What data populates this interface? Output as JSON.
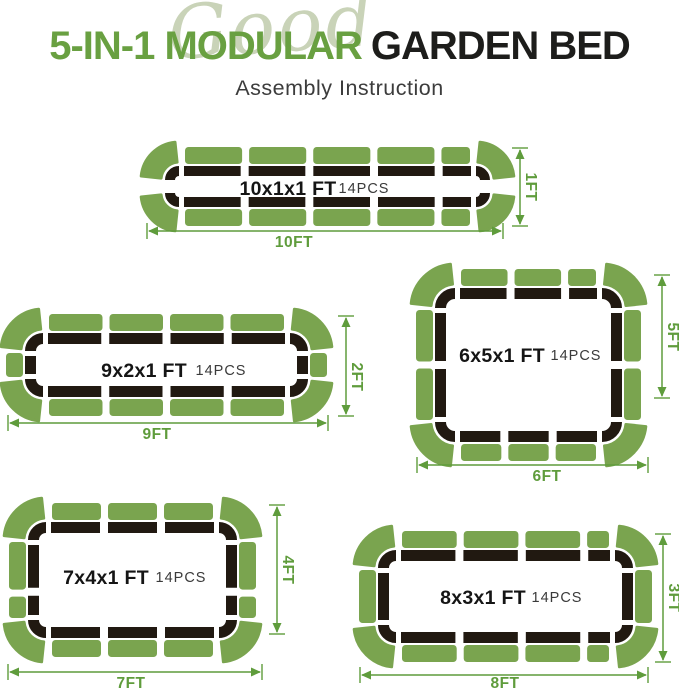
{
  "header": {
    "script_word": "Good",
    "title_green": "5-IN-1 MODULAR",
    "title_black": "GARDEN BED",
    "subtitle": "Assembly Instruction"
  },
  "colors": {
    "panel_green": "#7aa44f",
    "dim_green": "#5f9c3c",
    "frame_black": "#211911",
    "bed_label": "#151515",
    "pcs_label": "#3a3a3a"
  },
  "beds": [
    {
      "id": "10x1x1",
      "label": "10x1x1 FT",
      "pcs": "14PCS",
      "frame": {
        "x": 165,
        "y": 166,
        "w": 325,
        "h": 41,
        "r": 14,
        "sw": 10
      },
      "rows": {
        "top": [
          1,
          1,
          1,
          1,
          0.5
        ],
        "bottom": [
          1,
          1,
          1,
          1,
          0.5
        ],
        "left": [],
        "right": []
      },
      "label_pos": {
        "x": 288,
        "y": 195
      },
      "pcs_pos": {
        "x": 364,
        "y": 193
      },
      "h_arrow": {
        "x1": 147,
        "x2": 503,
        "y": 231,
        "label": "10FT",
        "lx": 294,
        "ly": 247
      },
      "v_arrow": {
        "y1": 148,
        "y2": 226,
        "x": 520,
        "label": "1FT",
        "lx": 526,
        "ly": 187
      }
    },
    {
      "id": "9x2x1",
      "label": "9x2x1 FT",
      "pcs": "14PCS",
      "frame": {
        "x": 25,
        "y": 333,
        "w": 283,
        "h": 64,
        "r": 18,
        "sw": 11
      },
      "rows": {
        "top": [
          1,
          1,
          1,
          1
        ],
        "bottom": [
          1,
          1,
          1,
          1
        ],
        "left": [
          1
        ],
        "right": [
          1
        ]
      },
      "label_pos": {
        "x": 144,
        "y": 377
      },
      "pcs_pos": {
        "x": 221,
        "y": 375
      },
      "h_arrow": {
        "x1": 8,
        "x2": 328,
        "y": 423,
        "label": "9FT",
        "lx": 157,
        "ly": 439
      },
      "v_arrow": {
        "y1": 316,
        "y2": 416,
        "x": 346,
        "label": "2FT",
        "lx": 352,
        "ly": 377
      }
    },
    {
      "id": "6x5x1",
      "label": "6x5x1 FT",
      "pcs": "14PCS",
      "frame": {
        "x": 435,
        "y": 288,
        "w": 187,
        "h": 154,
        "r": 20,
        "sw": 11
      },
      "rows": {
        "top": [
          1,
          1,
          0.6
        ],
        "bottom": [
          1,
          1,
          1
        ],
        "left": [
          1,
          1
        ],
        "right": [
          1,
          1
        ]
      },
      "label_pos": {
        "x": 502,
        "y": 362
      },
      "pcs_pos": {
        "x": 576,
        "y": 360
      },
      "h_arrow": {
        "x1": 417,
        "x2": 648,
        "y": 465,
        "label": "6FT",
        "lx": 547,
        "ly": 481
      },
      "v_arrow": {
        "y1": 275,
        "y2": 398,
        "x": 662,
        "label": "5FT",
        "lx": 668,
        "ly": 337
      }
    },
    {
      "id": "7x4x1",
      "label": "7x4x1 FT",
      "pcs": "14PCS",
      "frame": {
        "x": 28,
        "y": 522,
        "w": 209,
        "h": 116,
        "r": 18,
        "sw": 11
      },
      "rows": {
        "top": [
          1,
          1,
          1
        ],
        "bottom": [
          1,
          1,
          1
        ],
        "left": [
          1,
          0.45
        ],
        "right": [
          1,
          0.45
        ]
      },
      "label_pos": {
        "x": 106,
        "y": 584
      },
      "pcs_pos": {
        "x": 181,
        "y": 582
      },
      "h_arrow": {
        "x1": 8,
        "x2": 262,
        "y": 672,
        "label": "7FT",
        "lx": 131,
        "ly": 688
      },
      "v_arrow": {
        "y1": 505,
        "y2": 634,
        "x": 277,
        "label": "4FT",
        "lx": 283,
        "ly": 570
      }
    },
    {
      "id": "8x3x1",
      "label": "8x3x1 FT",
      "pcs": "14PCS",
      "frame": {
        "x": 378,
        "y": 550,
        "w": 255,
        "h": 93,
        "r": 18,
        "sw": 11
      },
      "rows": {
        "top": [
          1,
          1,
          1,
          0.4
        ],
        "bottom": [
          1,
          1,
          1,
          0.4
        ],
        "left": [
          1
        ],
        "right": [
          1
        ]
      },
      "label_pos": {
        "x": 483,
        "y": 604
      },
      "pcs_pos": {
        "x": 557,
        "y": 602
      },
      "h_arrow": {
        "x1": 360,
        "x2": 648,
        "y": 675,
        "label": "8FT",
        "lx": 505,
        "ly": 688
      },
      "v_arrow": {
        "y1": 534,
        "y2": 662,
        "x": 663,
        "label": "3FT",
        "lx": 669,
        "ly": 598
      }
    }
  ]
}
